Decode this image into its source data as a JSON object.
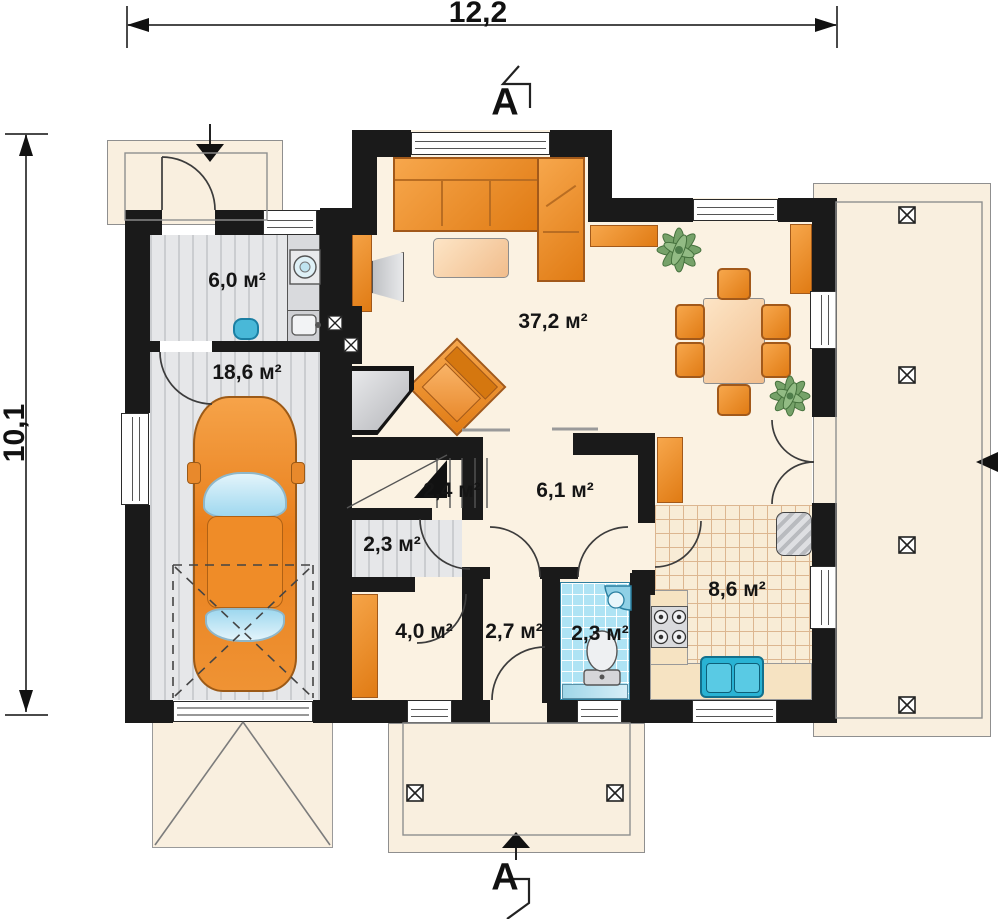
{
  "drawing": {
    "kind": "floor-plan",
    "dimensions": {
      "width_label": "12,2",
      "height_label": "10,1"
    },
    "section": {
      "label": "A"
    },
    "rooms": [
      {
        "name": "utility-room",
        "area": "6,0 м²"
      },
      {
        "name": "garage",
        "area": "18,6 м²"
      },
      {
        "name": "living-room",
        "area": "37,2 м²"
      },
      {
        "name": "stairs",
        "area": "2,4 м²"
      },
      {
        "name": "stairs-landing",
        "area": "2,3 м²"
      },
      {
        "name": "hall",
        "area": "6,1 м²"
      },
      {
        "name": "storage",
        "area": "4,0 м²"
      },
      {
        "name": "vestibule",
        "area": "2,7 м²"
      },
      {
        "name": "bathroom",
        "area": "2,3 м²"
      },
      {
        "name": "kitchen",
        "area": "8,6 м²"
      }
    ],
    "symbols": {
      "post": "crossed-square-post",
      "entrance": "solid-arrow",
      "section_cut": "flag-polyline",
      "garage_clearance": "dashed-cross"
    },
    "colors": {
      "wall": "#1a1a1a",
      "interior_floor": "#fbf2e2",
      "garage_floor": "#e6e7e9",
      "kitchen_tile": "#f8ecd6",
      "bath_tile": "#aee3f4",
      "furniture_orange": "#e8872a",
      "porch": "#f9efdf",
      "car_glass": "#bfe4f5"
    }
  }
}
